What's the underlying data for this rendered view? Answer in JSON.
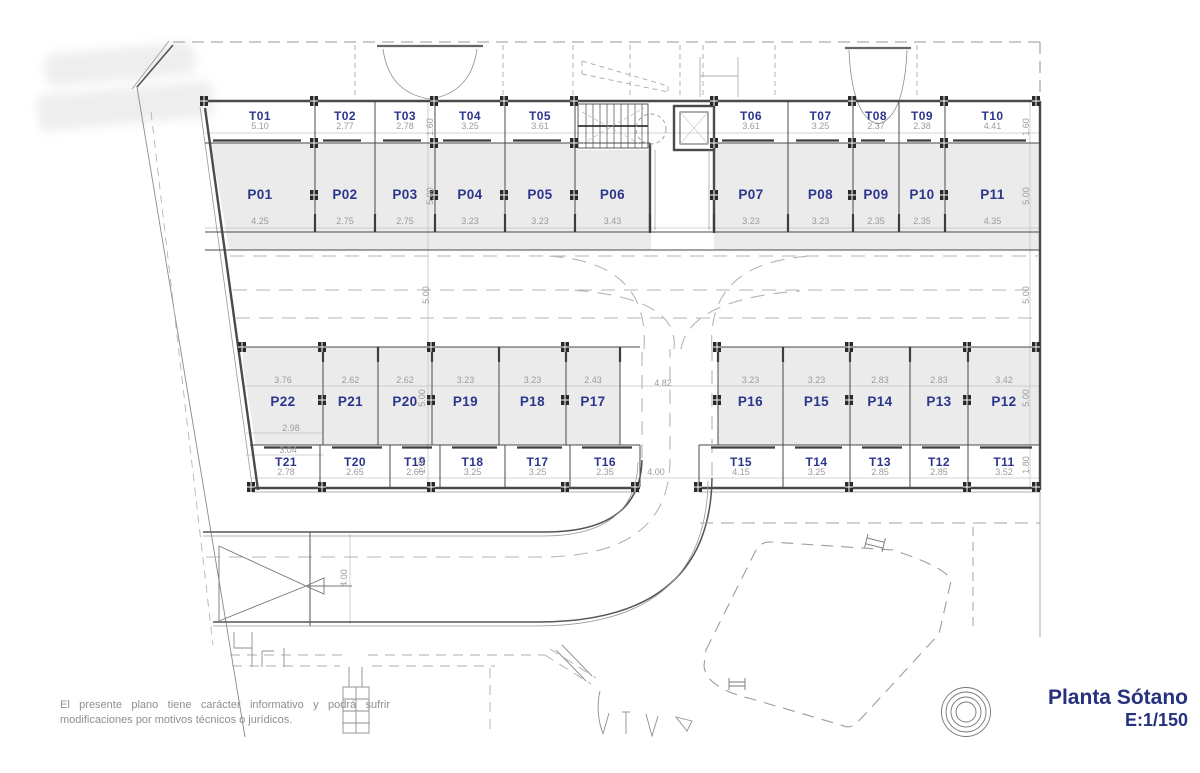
{
  "title_block": {
    "title": "Planta Sótano",
    "scale": "E:1/150"
  },
  "disclaimer": "El presente plano tiene carácter informativo y podrá sufrir modificaciones por motivos técnicos o jurídicos.",
  "colors": {
    "label_blue": "#2c358c",
    "dim_gray": "#9c9c9c",
    "fill_gray": "#ebebeb"
  },
  "rows": {
    "storage_top": [
      {
        "id": "T01",
        "dim": "5.10"
      },
      {
        "id": "T02",
        "dim": "2.77"
      },
      {
        "id": "T03",
        "dim": "2.78"
      },
      {
        "id": "T04",
        "dim": "3.25"
      },
      {
        "id": "T05",
        "dim": "3.61"
      },
      {
        "id": "T06",
        "dim": "3.61"
      },
      {
        "id": "T07",
        "dim": "3.25"
      },
      {
        "id": "T08",
        "dim": "2.37"
      },
      {
        "id": "T09",
        "dim": "2.38"
      },
      {
        "id": "T10",
        "dim": "4.41"
      }
    ],
    "parking_top": [
      {
        "id": "P01",
        "dim": "4.25"
      },
      {
        "id": "P02",
        "dim": "2.75"
      },
      {
        "id": "P03",
        "dim": "2.75"
      },
      {
        "id": "P04",
        "dim": "3.23"
      },
      {
        "id": "P05",
        "dim": "3.23"
      },
      {
        "id": "P06",
        "dim": "3.43"
      },
      {
        "id": "P07",
        "dim": "3.23"
      },
      {
        "id": "P08",
        "dim": "3.23"
      },
      {
        "id": "P09",
        "dim": "2.35"
      },
      {
        "id": "P10",
        "dim": "2.35"
      },
      {
        "id": "P11",
        "dim": "4.35"
      }
    ],
    "parking_mid": [
      {
        "id": "P22",
        "dim": "3.76"
      },
      {
        "id": "P21",
        "dim": "2.62"
      },
      {
        "id": "P20",
        "dim": "2.62"
      },
      {
        "id": "P19",
        "dim": "3.23"
      },
      {
        "id": "P18",
        "dim": "3.23"
      },
      {
        "id": "P17",
        "dim": "2.43"
      },
      {
        "id": "P16",
        "dim": "3.23"
      },
      {
        "id": "P15",
        "dim": "3.23"
      },
      {
        "id": "P14",
        "dim": "2.83"
      },
      {
        "id": "P13",
        "dim": "2.83"
      },
      {
        "id": "P12",
        "dim": "3.42"
      }
    ],
    "storage_bottom": [
      {
        "id": "T21",
        "dim": "2.78"
      },
      {
        "id": "T20",
        "dim": "2.65"
      },
      {
        "id": "T19",
        "dim": "2.65"
      },
      {
        "id": "T18",
        "dim": "3.25"
      },
      {
        "id": "T17",
        "dim": "3.25"
      },
      {
        "id": "T16",
        "dim": "2.35"
      },
      {
        "id": "T15",
        "dim": "4.15"
      },
      {
        "id": "T14",
        "dim": "3.25"
      },
      {
        "id": "T13",
        "dim": "2.85"
      },
      {
        "id": "T12",
        "dim": "2.85"
      },
      {
        "id": "T11",
        "dim": "3.52"
      }
    ]
  },
  "dimensions": [
    {
      "id": "storage-top-depth-left",
      "text": "1.60"
    },
    {
      "id": "storage-top-depth-right",
      "text": "1.60"
    },
    {
      "id": "parking-top-depth-left",
      "text": "5.00"
    },
    {
      "id": "parking-top-depth-right",
      "text": "5.00"
    },
    {
      "id": "aisle-width-left",
      "text": "5.00"
    },
    {
      "id": "aisle-width-right",
      "text": "5.00"
    },
    {
      "id": "parking-mid-depth-left",
      "text": "5.00"
    },
    {
      "id": "parking-mid-depth-right",
      "text": "5.00"
    },
    {
      "id": "storage-bottom-depth-left",
      "text": "1.80"
    },
    {
      "id": "storage-bottom-depth-right",
      "text": "1.80"
    },
    {
      "id": "ramp-corridor-top",
      "text": "4.82"
    },
    {
      "id": "ramp-corridor-bottom",
      "text": "4.00"
    },
    {
      "id": "entrance-ramp-width",
      "text": "4.00"
    },
    {
      "id": "p22-inner-width",
      "text": "2.98"
    },
    {
      "id": "t21-top-width",
      "text": "3.04"
    }
  ]
}
